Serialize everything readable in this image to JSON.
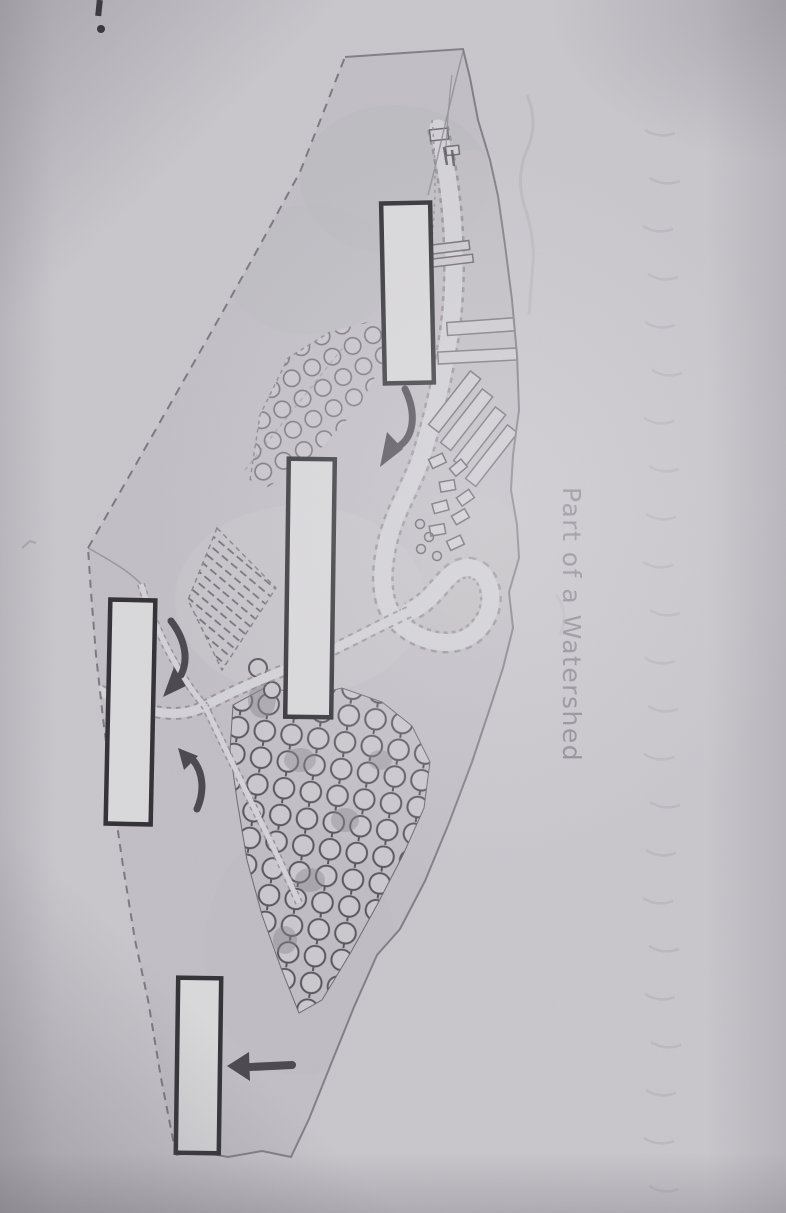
{
  "diagram": {
    "title": "Part of a Watershed",
    "question_mark": "1.",
    "label_boxes": [
      {
        "id": "upper-box",
        "text": ""
      },
      {
        "id": "middle-box",
        "text": ""
      },
      {
        "id": "left-box",
        "text": ""
      },
      {
        "id": "lower-box",
        "text": ""
      }
    ],
    "colors": {
      "paper": "#c8c6cb",
      "terrain_fill": "#c1bfc5",
      "line_ink": "#817e85",
      "dark_ink": "#4a474e",
      "box_fill": "#d9d8db",
      "box_border": "#313035",
      "river_fill": "#d3d2d6",
      "title_text": "#8d8992"
    }
  }
}
